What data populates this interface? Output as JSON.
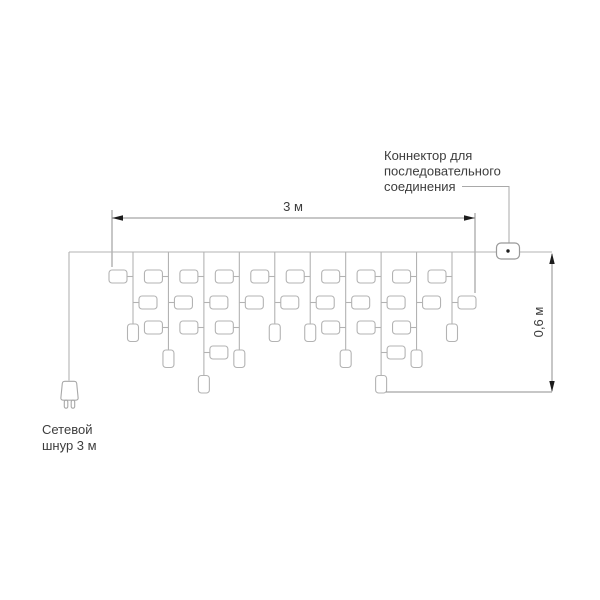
{
  "diagram": {
    "labels": {
      "width_dimension": "3 м",
      "height_dimension": "0,6 м",
      "connector_callout_line1": "Коннектор для",
      "connector_callout_line2": "последовательного",
      "connector_callout_line3": "соединения",
      "power_cord_label_line1": "Сетевой",
      "power_cord_label_line2": "шнур 3 м"
    },
    "colors": {
      "background": "#ffffff",
      "garland_line": "#b3b3b3",
      "dimension_line": "#8f8f8f",
      "arrowhead": "#1c1c1c",
      "text": "#3d3d3d"
    },
    "garland": {
      "drop_count": 10,
      "drop_pattern": [
        "short",
        "medium",
        "long",
        "medium",
        "short",
        "short",
        "medium",
        "long",
        "medium",
        "short"
      ],
      "side_bulbs_per_drop": {
        "short": 2,
        "medium": 3,
        "long": 4
      },
      "end_bulbs_per_drop": 1
    }
  }
}
